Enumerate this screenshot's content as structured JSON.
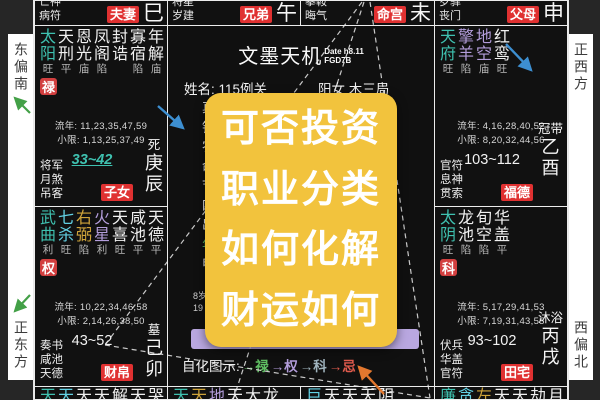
{
  "app": {
    "title": "文墨天机",
    "version_line1": "Date h8.11",
    "version_line2": "FGD7B"
  },
  "compass": {
    "top_left": "东偏南",
    "bottom_left": "正东方",
    "top_right": "正西方",
    "bottom_right": "西偏北"
  },
  "center": {
    "name_line": "姓名: 115例关",
    "info_line": "阳女 木三局",
    "left_fragments": [
      {
        "c": "真",
        "col": "#ededed"
      },
      {
        "c": "钟",
        "col": "#ededed"
      },
      {
        "c": "农",
        "col": "#ededed"
      },
      {
        "c": "命",
        "col": "#ededed"
      },
      {
        "c": "节",
        "col": "#ededed"
      },
      {
        "c": "四",
        "col": "#ededed"
      },
      {
        "c": "出",
        "col": "#ededed"
      },
      {
        "c": "年",
        "col": "#5fbf62"
      },
      {
        "c": "申",
        "col": "#ededed"
      }
    ],
    "right_fragments": [
      {
        "c": "1",
        "col": "#ededed"
      },
      {
        "c": "2",
        "col": "#ededed"
      },
      {
        "c": "时",
        "col": "#ededed"
      },
      {
        "c": "未",
        "col": "#ededed"
      }
    ],
    "sub_left": [
      "8岁",
      "19"
    ],
    "sub_right": [
      "2岁",
      "57"
    ],
    "legend_label": "自化图示:",
    "legend_items": [
      {
        "text": "→禄",
        "color": "#5fbf62"
      },
      {
        "text": "→权",
        "color": "#b39ddb"
      },
      {
        "text": "→科",
        "color": "#9fb3bd"
      },
      {
        "text": "→忌",
        "color": "#e05b4d"
      }
    ],
    "pan_badge": "盘"
  },
  "overlay": {
    "bg": "#f2c33d",
    "lines": [
      "可否投资",
      "职业分类",
      "如何化解",
      "财运如何"
    ]
  },
  "palaces": {
    "si": {
      "minor1": "亡神",
      "minor2": "病符",
      "label": "夫妻",
      "branch": "巳"
    },
    "wu": {
      "minor1": "将星",
      "minor2": "岁建",
      "label": "兄弟",
      "branch": "午"
    },
    "wei": {
      "minor1": "攀鞍",
      "minor2": "晦气",
      "label": "命宫",
      "branch": "未"
    },
    "shen": {
      "minor1": "岁驿",
      "minor2": "丧门",
      "label": "父母",
      "branch": "申"
    },
    "chen": {
      "stars": [
        {
          "c": "太阳",
          "s": "旺",
          "col": "#3fc1b0"
        },
        {
          "c": "天刑",
          "s": "平",
          "col": "#f0f0f0"
        },
        {
          "c": "恩光",
          "s": "庙",
          "col": "#f0f0f0"
        },
        {
          "c": "凤阁",
          "s": "陷",
          "col": "#f0f0f0"
        },
        {
          "c": "封诰",
          "s": "",
          "col": "#f0f0f0"
        },
        {
          "c": "寡宿",
          "s": "陷",
          "col": "#f0f0f0"
        },
        {
          "c": "年解",
          "s": "庙",
          "col": "#f0f0f0"
        }
      ],
      "hua": "禄",
      "liunian": "流年: 11,23,35,47,59",
      "xiaoxian": "小限: 1,13,25,37,49",
      "minors": [
        "将军",
        "月煞",
        "吊客"
      ],
      "range": "33~42",
      "stage": "死",
      "stem": "庚",
      "branch": "辰",
      "label": "子女"
    },
    "mao": {
      "stars": [
        {
          "c": "武曲",
          "s": "利",
          "col": "#3fc1b0"
        },
        {
          "c": "七杀",
          "s": "旺",
          "col": "#62d0e3"
        },
        {
          "c": "右弼",
          "s": "陷",
          "col": "#cfa43a"
        },
        {
          "c": "火星",
          "s": "利",
          "col": "#b39ddb"
        },
        {
          "c": "天喜",
          "s": "旺",
          "col": "#f0f0f0"
        },
        {
          "c": "咸池",
          "s": "平",
          "col": "#f0f0f0"
        },
        {
          "c": "天德",
          "s": "平",
          "col": "#f0f0f0"
        }
      ],
      "hua": "权",
      "liunian": "流年: 10,22,34,46,58",
      "xiaoxian": "小限: 2,14,26,38,50",
      "minors": [
        "奏书",
        "咸池",
        "天德"
      ],
      "range": "43~52",
      "stage": "墓",
      "stem": "己",
      "branch": "卯",
      "label": "财帛"
    },
    "you": {
      "stars": [
        {
          "c": "天府",
          "s": "旺",
          "col": "#3fc1b0"
        },
        {
          "c": "擎羊",
          "s": "陷",
          "col": "#b39ddb"
        },
        {
          "c": "地空",
          "s": "庙",
          "col": "#b39ddb"
        },
        {
          "c": "红鸾",
          "s": "旺",
          "col": "#f0f0f0"
        }
      ],
      "hua": "",
      "liunian": "流年: 4,16,28,40,52",
      "xiaoxian": "小限: 8,20,32,44,56",
      "minors": [
        "官符",
        "息神",
        "贯索"
      ],
      "range": "103~112",
      "stage": "冠带",
      "stem": "乙",
      "branch": "酉",
      "label": "福德"
    },
    "xu": {
      "stars": [
        {
          "c": "太阴",
          "s": "旺",
          "col": "#3fc1b0"
        },
        {
          "c": "龙池",
          "s": "陷",
          "col": "#f0f0f0"
        },
        {
          "c": "旬空",
          "s": "陷",
          "col": "#f0f0f0"
        },
        {
          "c": "华盖",
          "s": "平",
          "col": "#f0f0f0"
        }
      ],
      "hua": "科",
      "liunian": "流年: 5,17,29,41,53",
      "xiaoxian": "小限: 7,19,31,43,55",
      "minors": [
        "伏兵",
        "华盖",
        "官符"
      ],
      "range": "93~102",
      "stage": "沐浴",
      "stem": "丙",
      "branch": "戌",
      "label": "田宅"
    },
    "yin_cut": [
      {
        "c": "天",
        "col": "#3fc1b0"
      },
      {
        "c": "天",
        "col": "#62d0e3"
      },
      {
        "c": "天",
        "col": "#f0f0f0"
      },
      {
        "c": "天",
        "col": "#f0f0f0"
      },
      {
        "c": "解",
        "col": "#f0f0f0"
      },
      {
        "c": "天",
        "col": "#f0f0f0"
      },
      {
        "c": "哭",
        "col": "#f0f0f0"
      }
    ],
    "chou_cut": [
      {
        "c": "天",
        "col": "#3fc1b0"
      },
      {
        "c": "天",
        "col": "#cfa43a"
      },
      {
        "c": "地",
        "col": "#b39ddb"
      },
      {
        "c": "天",
        "col": "#f0f0f0"
      },
      {
        "c": "大",
        "col": "#f0f0f0"
      },
      {
        "c": "龙",
        "col": "#f0f0f0"
      }
    ],
    "zi_cut": [
      {
        "c": "巨",
        "col": "#62d0e3"
      },
      {
        "c": "天",
        "col": "#f0f0f0"
      },
      {
        "c": "天",
        "col": "#f0f0f0"
      },
      {
        "c": "天",
        "col": "#f0f0f0"
      },
      {
        "c": "阴",
        "col": "#f0f0f0"
      }
    ],
    "hai_cut": [
      {
        "c": "廉",
        "col": "#3fc1b0"
      },
      {
        "c": "贪",
        "col": "#62d0e3"
      },
      {
        "c": "左",
        "col": "#cfa43a"
      },
      {
        "c": "天",
        "col": "#f0f0f0"
      },
      {
        "c": "天",
        "col": "#f0f0f0"
      },
      {
        "c": "劫",
        "col": "#f0f0f0"
      },
      {
        "c": "月",
        "col": "#f0f0f0"
      }
    ]
  },
  "colors": {
    "major_star": "#3fc1b0",
    "secondary_star": "#62d0e3",
    "assist_star": "#cfa43a",
    "malefic_star": "#b39ddb",
    "palace_label_bg": "#e03131",
    "hua_badge_bg": "#d23f3f",
    "overlay_bg": "#f2c33d",
    "annotation_green": "#43a047",
    "annotation_blue": "#3d8fd1",
    "annotation_orange": "#e2772e",
    "decade_bar": "#b9a7e0",
    "pan_badge": "#8f6fd0"
  }
}
